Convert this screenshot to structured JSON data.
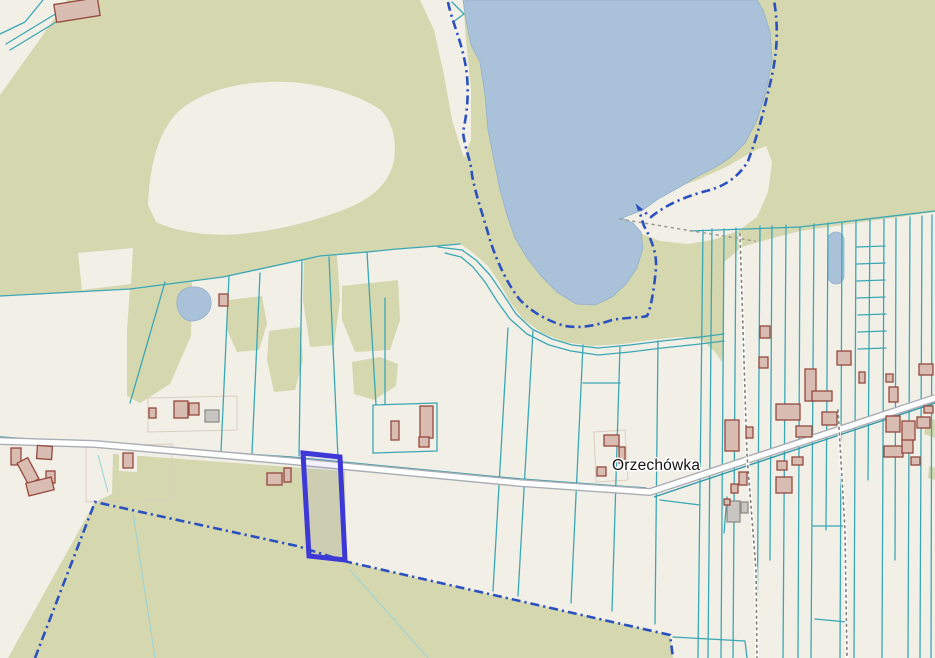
{
  "map": {
    "place_label": "Orzechówka",
    "selected_parcel": {
      "points": "303,453 340,457 345,560 309,556"
    }
  },
  "palette": {
    "bg": "#f2efe7",
    "forest": "#d5d7af",
    "water": "#a9c2da",
    "water_edge": "#93afcb",
    "parcel": "#3aa7b5",
    "parcel_dark": "#2f9aa8",
    "parcel_faint": "#9ed3d6",
    "road_fill": "#ffffff",
    "road_casing": "#a9adb4",
    "building_fill": "#d9bdb2",
    "building_stroke": "#95493c",
    "building_gray_fill": "#c9c5c1",
    "building_gray_stroke": "#898983",
    "admin_boundary": "#2b50c0",
    "selected_stroke": "#3e38d6",
    "selected_fill": "rgba(62,56,214,0.06)",
    "label": "#141414",
    "path_dots": "#84847a",
    "path_gray": "#9a9a92",
    "farmline": "#dccdc0"
  },
  "features": {
    "parcel_lines": [
      {
        "cls": "teal",
        "points": "0,296 130,289 223,277 320,256 367,252 397,249 437,246 460,244"
      },
      {
        "cls": "teal",
        "points": "438,247 462,250 476,260 490,275 503,294 516,314 532,329 552,339 572,345 598,348 630,345 662,341 700,337 724,334"
      },
      {
        "cls": "teal",
        "points": "445,253 461,257 473,267 485,282 497,301 510,319 527,334 549,345 571,351 598,355 630,352 662,348 700,344 724,341"
      },
      {
        "cls": "teal",
        "points": "690,231 800,227 935,211"
      },
      {
        "cls": "teal",
        "points": "165,282 130,403"
      },
      {
        "cls": "teal",
        "points": "229,276 221,452"
      },
      {
        "cls": "teal",
        "points": "260,273 252,453"
      },
      {
        "cls": "teal",
        "points": "302,260 299,456"
      },
      {
        "cls": "teal",
        "points": "329,257 338,458"
      },
      {
        "cls": "teal",
        "points": "367,252 376,405"
      },
      {
        "cls": "teal",
        "points": "385,298 385,404"
      },
      {
        "cls": "teal",
        "points": "373,405 437,403 437,451 373,453 373,405"
      },
      {
        "cls": "teal",
        "points": "508,328 493,591"
      },
      {
        "cls": "teal",
        "points": "533,331 518,596"
      },
      {
        "cls": "teal",
        "points": "583,345 571,603"
      },
      {
        "cls": "teal",
        "points": "620,347 612,611"
      },
      {
        "cls": "teal",
        "points": "658,341 655,624"
      },
      {
        "cls": "teal",
        "points": "583,383 620,383"
      },
      {
        "cls": "teal",
        "points": "660,500 700,505"
      },
      {
        "cls": "teal",
        "points": "727,497 724,533"
      },
      {
        "cls": "teal",
        "points": "703,230 698,658"
      },
      {
        "cls": "teal",
        "points": "712,229 708,658"
      },
      {
        "cls": "teal",
        "points": "724,229 721,658"
      },
      {
        "cls": "teal",
        "points": "736,228 733,658"
      },
      {
        "cls": "teal",
        "points": "760,226 757,658"
      },
      {
        "cls": "teal",
        "points": "772,226 770,560"
      },
      {
        "cls": "teal",
        "points": "786,225 783,658"
      },
      {
        "cls": "teal",
        "points": "800,227 798,658"
      },
      {
        "cls": "teal",
        "points": "814,224 811,658"
      },
      {
        "cls": "teal",
        "points": "828,223 826,530"
      },
      {
        "cls": "teal",
        "points": "842,222 840,658"
      },
      {
        "cls": "teal",
        "points": "856,221 854,658"
      },
      {
        "cls": "teal",
        "points": "870,220 868,480"
      },
      {
        "cls": "teal",
        "points": "884,219 882,658"
      },
      {
        "cls": "teal",
        "points": "896,218 895,560"
      },
      {
        "cls": "teal",
        "points": "910,217 908,658"
      },
      {
        "cls": "teal",
        "points": "922,216 920,658"
      },
      {
        "cls": "teal",
        "points": "932,215 931,658"
      },
      {
        "cls": "teal",
        "points": "857,247 885,246"
      },
      {
        "cls": "teal",
        "points": "857,264 885,263"
      },
      {
        "cls": "teal",
        "points": "857,281 885,280"
      },
      {
        "cls": "teal",
        "points": "857,298 885,297"
      },
      {
        "cls": "teal",
        "points": "858,315 886,314"
      },
      {
        "cls": "teal",
        "points": "858,332 886,331"
      },
      {
        "cls": "teal",
        "points": "858,349 886,348"
      },
      {
        "cls": "teal",
        "points": "813,526 843,526"
      },
      {
        "cls": "teal",
        "points": "815,619 847,622"
      },
      {
        "cls": "teal",
        "points": "673,637 745,641 747,658"
      },
      {
        "cls": "teal-dark",
        "points": "0,437 290,457 520,479 646,488"
      },
      {
        "cls": "teal-dark",
        "points": "654,497 935,403"
      },
      {
        "cls": "teal",
        "points": "43,0 25,22 0,34"
      },
      {
        "cls": "teal",
        "points": "62,10 34,27 6,44"
      },
      {
        "cls": "teal",
        "points": "66,16 38,33 10,50"
      },
      {
        "cls": "teal",
        "points": "452,2 464,14 453,22"
      },
      {
        "cls": "teal-faint",
        "points": "133,513 155,658"
      },
      {
        "cls": "teal-faint",
        "points": "350,570 428,658"
      },
      {
        "cls": "teal-faint",
        "points": "98,455 108,492"
      }
    ],
    "dotted_tracks": [
      "740,234 747,455 756,570 757,658",
      "838,410 845,530 847,658"
    ],
    "dotted_gray_paths": [
      "620,219 680,229 755,241"
    ],
    "admin_boundaries": [
      "M448,2 C452,22 462,42 466,68 C470,95 466,118 463,132 C465,150 471,160 472,175 C476,196 483,215 490,240 C497,262 508,285 520,300 C533,313 548,321 565,326 C578,328 592,327 612,320 C628,317 640,318 647,316 C651,308 654,290 656,268 C657,255 652,240 644,226 L638,207 L651,217 C668,203 690,195 710,190 C727,185 740,175 748,161 C756,140 763,115 770,84 C777,55 779,30 774,0",
      "M35,658 L95,502 L297,546 L348,562 L670,635 L673,658"
    ],
    "buildings": [
      {
        "x": 55,
        "y": 1,
        "w": 44,
        "h": 18,
        "r": -9,
        "t": "red"
      },
      {
        "x": 11,
        "y": 448,
        "w": 10,
        "h": 17,
        "r": 0,
        "t": "red"
      },
      {
        "x": 37,
        "y": 446,
        "w": 15,
        "h": 13,
        "r": 4,
        "t": "red"
      },
      {
        "x": 22,
        "y": 459,
        "w": 12,
        "h": 24,
        "r": -28,
        "t": "red"
      },
      {
        "x": 46,
        "y": 471,
        "w": 9,
        "h": 12,
        "r": 0,
        "t": "red"
      },
      {
        "x": 27,
        "y": 480,
        "w": 26,
        "h": 13,
        "r": -14,
        "t": "red"
      },
      {
        "x": 123,
        "y": 453,
        "w": 10,
        "h": 15,
        "r": 0,
        "t": "red"
      },
      {
        "x": 219,
        "y": 294,
        "w": 9,
        "h": 12,
        "r": 0,
        "t": "red"
      },
      {
        "x": 149,
        "y": 408,
        "w": 7,
        "h": 10,
        "r": 0,
        "t": "red"
      },
      {
        "x": 174,
        "y": 401,
        "w": 14,
        "h": 17,
        "r": 0,
        "t": "red"
      },
      {
        "x": 189,
        "y": 403,
        "w": 10,
        "h": 12,
        "r": 0,
        "t": "red"
      },
      {
        "x": 205,
        "y": 410,
        "w": 14,
        "h": 12,
        "r": 0,
        "t": "gray"
      },
      {
        "x": 391,
        "y": 421,
        "w": 8,
        "h": 19,
        "r": 0,
        "t": "red"
      },
      {
        "x": 420,
        "y": 406,
        "w": 13,
        "h": 32,
        "r": 0,
        "t": "red"
      },
      {
        "x": 419,
        "y": 437,
        "w": 10,
        "h": 10,
        "r": 0,
        "t": "red"
      },
      {
        "x": 267,
        "y": 473,
        "w": 15,
        "h": 12,
        "r": 0,
        "t": "red"
      },
      {
        "x": 284,
        "y": 468,
        "w": 7,
        "h": 14,
        "r": 0,
        "t": "red"
      },
      {
        "x": 604,
        "y": 435,
        "w": 15,
        "h": 11,
        "r": 0,
        "t": "red"
      },
      {
        "x": 619,
        "y": 447,
        "w": 6,
        "h": 16,
        "r": 0,
        "t": "red"
      },
      {
        "x": 597,
        "y": 467,
        "w": 9,
        "h": 9,
        "r": 0,
        "t": "red"
      },
      {
        "x": 725,
        "y": 420,
        "w": 14,
        "h": 31,
        "r": 0,
        "t": "red"
      },
      {
        "x": 746,
        "y": 427,
        "w": 7,
        "h": 11,
        "r": 0,
        "t": "red"
      },
      {
        "x": 805,
        "y": 369,
        "w": 11,
        "h": 32,
        "r": 0,
        "t": "red"
      },
      {
        "x": 812,
        "y": 391,
        "w": 20,
        "h": 10,
        "r": 0,
        "t": "red"
      },
      {
        "x": 760,
        "y": 326,
        "w": 10,
        "h": 12,
        "r": 0,
        "t": "red"
      },
      {
        "x": 759,
        "y": 357,
        "w": 9,
        "h": 11,
        "r": 0,
        "t": "red"
      },
      {
        "x": 837,
        "y": 351,
        "w": 14,
        "h": 14,
        "r": 0,
        "t": "red"
      },
      {
        "x": 859,
        "y": 372,
        "w": 6,
        "h": 11,
        "r": 0,
        "t": "red"
      },
      {
        "x": 886,
        "y": 374,
        "w": 7,
        "h": 8,
        "r": 0,
        "t": "red"
      },
      {
        "x": 889,
        "y": 387,
        "w": 9,
        "h": 15,
        "r": 0,
        "t": "red"
      },
      {
        "x": 919,
        "y": 364,
        "w": 14,
        "h": 11,
        "r": 0,
        "t": "red"
      },
      {
        "x": 917,
        "y": 417,
        "w": 13,
        "h": 11,
        "r": 0,
        "t": "red"
      },
      {
        "x": 822,
        "y": 412,
        "w": 15,
        "h": 13,
        "r": 0,
        "t": "red"
      },
      {
        "x": 796,
        "y": 426,
        "w": 16,
        "h": 11,
        "r": 0,
        "t": "red"
      },
      {
        "x": 776,
        "y": 404,
        "w": 24,
        "h": 16,
        "r": 0,
        "t": "red"
      },
      {
        "x": 731,
        "y": 484,
        "w": 7,
        "h": 9,
        "r": 0,
        "t": "red"
      },
      {
        "x": 739,
        "y": 472,
        "w": 8,
        "h": 13,
        "r": 0,
        "t": "red"
      },
      {
        "x": 727,
        "y": 501,
        "w": 13,
        "h": 21,
        "r": 0,
        "t": "gray"
      },
      {
        "x": 741,
        "y": 502,
        "w": 7,
        "h": 11,
        "r": 0,
        "t": "gray"
      },
      {
        "x": 776,
        "y": 477,
        "w": 16,
        "h": 16,
        "r": 0,
        "t": "red"
      },
      {
        "x": 777,
        "y": 461,
        "w": 10,
        "h": 9,
        "r": 0,
        "t": "red"
      },
      {
        "x": 792,
        "y": 457,
        "w": 11,
        "h": 8,
        "r": 0,
        "t": "red"
      },
      {
        "x": 884,
        "y": 446,
        "w": 19,
        "h": 11,
        "r": 0,
        "t": "red"
      },
      {
        "x": 902,
        "y": 439,
        "w": 11,
        "h": 14,
        "r": 0,
        "t": "red"
      },
      {
        "x": 911,
        "y": 457,
        "w": 9,
        "h": 8,
        "r": 0,
        "t": "red"
      },
      {
        "x": 886,
        "y": 416,
        "w": 14,
        "h": 16,
        "r": 0,
        "t": "red"
      },
      {
        "x": 902,
        "y": 421,
        "w": 13,
        "h": 19,
        "r": 0,
        "t": "red"
      },
      {
        "x": 924,
        "y": 406,
        "w": 9,
        "h": 7,
        "r": 0,
        "t": "red"
      },
      {
        "x": 724,
        "y": 499,
        "w": 6,
        "h": 6,
        "r": 0,
        "t": "red"
      }
    ]
  }
}
